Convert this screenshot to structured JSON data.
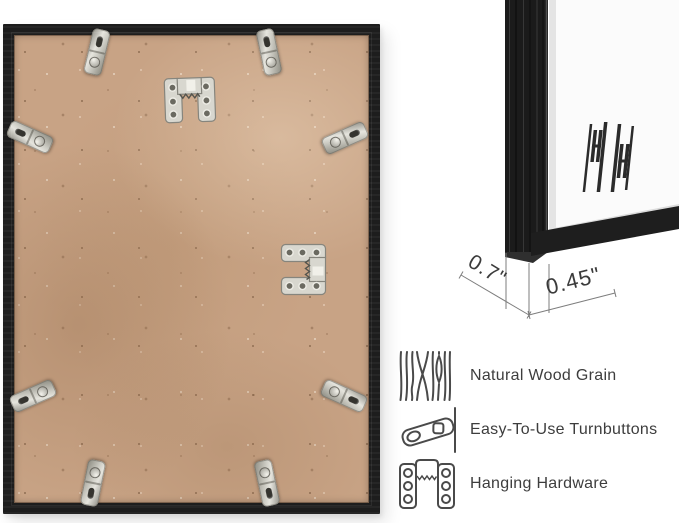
{
  "canvas": {
    "width": 679,
    "height": 523,
    "background": "#ffffff"
  },
  "measurements": {
    "depth": "0.7\"",
    "face": "0.45\""
  },
  "features": [
    {
      "icon": "wood-grain-icon",
      "label": "Natural Wood Grain"
    },
    {
      "icon": "turnbutton-icon",
      "label": "Easy-To-Use Turnbuttons"
    },
    {
      "icon": "hanging-hardware-icon",
      "label": "Hanging Hardware"
    }
  ],
  "icons": {
    "photo": [
      "turnbutton-clip",
      "sawtooth-hanger"
    ],
    "diagram": [
      "brand-logo"
    ]
  },
  "colors": {
    "frame": "#1d1d1d",
    "board": "#c8a385",
    "metal": "#d8d7cf",
    "mat": "#fbfbfb",
    "text": "#3d3d3d",
    "dimension_line": "#7d7d7d"
  }
}
